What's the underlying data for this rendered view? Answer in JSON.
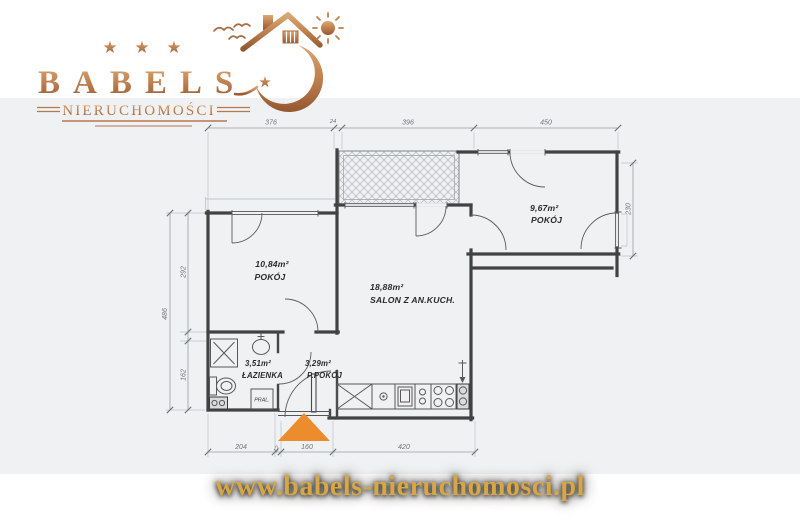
{
  "brand": {
    "stars": [
      "★",
      "★",
      "★"
    ],
    "name": "BABELS",
    "accent_star": "★",
    "tagline": "NIERUCHOMOŚCI",
    "copper": "#b5794e"
  },
  "floorplan": {
    "rooms": [
      {
        "area": "10,84m²",
        "name": "POKÓJ"
      },
      {
        "area": "18,88m²",
        "name": "SALON Z AN.KUCH."
      },
      {
        "area": "9,67m²",
        "name": "POKÓJ"
      },
      {
        "area": "3,51m²",
        "name": "ŁAZIENKA"
      },
      {
        "area": "3,29m²",
        "name": "P.POKÓJ"
      }
    ],
    "appliances": {
      "washer": "PRAL."
    },
    "dims": {
      "top": [
        "376",
        "24",
        "396",
        "450"
      ],
      "bottom": [
        "204",
        "12",
        "160",
        "420"
      ],
      "left_total": "486",
      "left_upper": "292",
      "left_lower": "162",
      "right": "230"
    },
    "entrance_color": "#ec8c2c"
  },
  "footer": {
    "url": "www.babels-nieruchomosci.pl",
    "gold": "#d7a647"
  }
}
